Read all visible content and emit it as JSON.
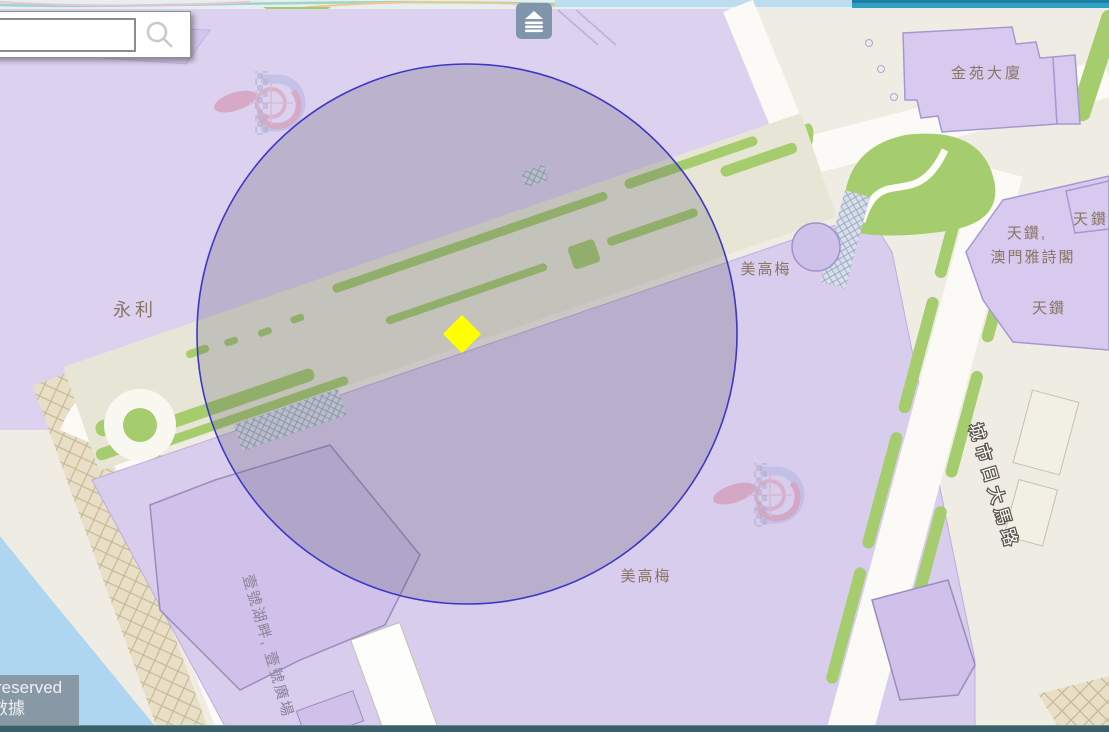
{
  "search": {
    "value": "",
    "placeholder": ""
  },
  "toolbar": {
    "layers_button_icon": "layers-eject-icon",
    "search_icon": "magnifier-icon"
  },
  "attribution": {
    "line1": "reserved",
    "line2": "數據"
  },
  "map": {
    "place_labels": [
      {
        "text": "永利"
      },
      {
        "text": "美高梅"
      },
      {
        "text": "美高梅"
      },
      {
        "text": "金苑大廈"
      },
      {
        "text": "天鑽"
      },
      {
        "text": "天鑽,"
      },
      {
        "text": "澳門雅詩閣"
      },
      {
        "text": "天鑽"
      }
    ],
    "street_label": {
      "text": "城市日大馬路"
    },
    "complex_label": {
      "text": "壹號湖畔, 壹號廣場"
    },
    "selection": {
      "shape": "circle",
      "cx": 467,
      "cy": 334,
      "r": 270,
      "stroke_color": "#3c36c9",
      "fill_color": "rgba(82,78,102,0.24)"
    },
    "marker": {
      "shape": "diamond",
      "color": "#ffff00",
      "x": 462,
      "y": 334
    },
    "theme_colors": {
      "parcel_lavender": "#dcd1ef",
      "green": "#a5cd6e",
      "road_white": "#fbfaf6",
      "water_blue": "#aed6f1",
      "base_cream": "#efede3",
      "top_bar_teal": "#2fa0c2",
      "bottom_bar_teal": "#3a616b",
      "label_brown": "#8a7565"
    }
  }
}
